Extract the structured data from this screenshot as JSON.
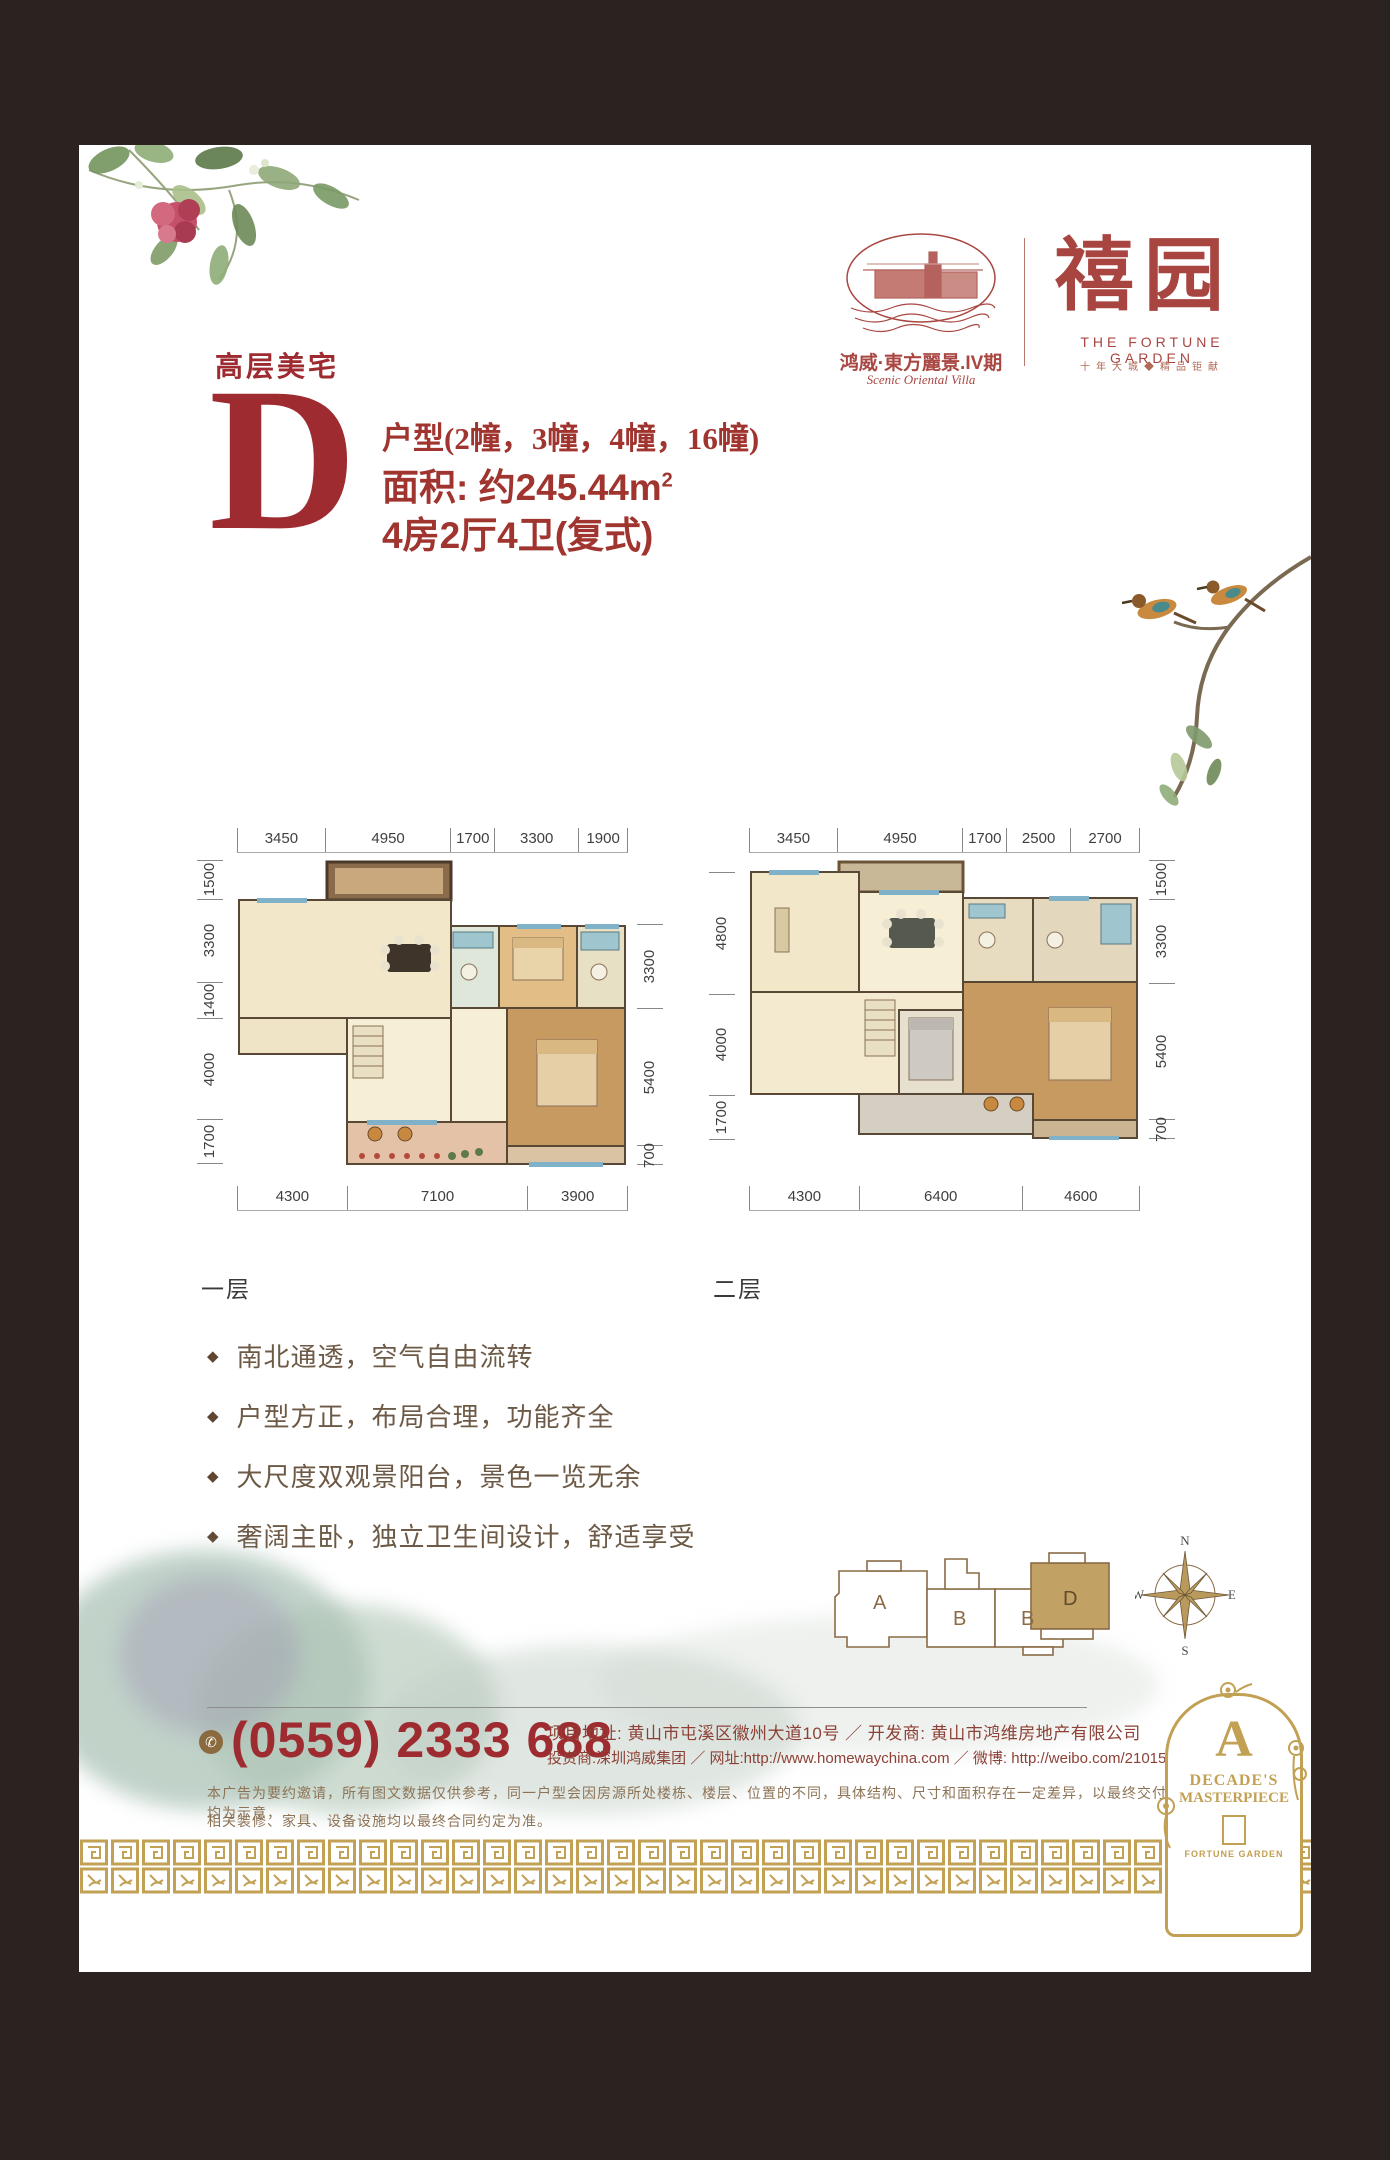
{
  "header": {
    "tagline": "高层美宅",
    "unit_letter": "D",
    "unit_type_line": "户型(2幢，3幢，4幢，16幢)",
    "area_label": "面积: 约245.44m",
    "area_sup": "2",
    "rooms_line": "4房2厅4卫(复式)"
  },
  "brand": {
    "left_logo_cn": "鸿威·東方麗景.IV期",
    "left_logo_en": "Scenic Oriental Villa",
    "right_logo_cn": "禧园",
    "right_logo_en": "THE FORTUNE GARDEN",
    "right_logo_sub": "十年大城◆精品钜献"
  },
  "plans": {
    "floor1": {
      "label": "一层",
      "top": [
        "3450",
        "4950",
        "1700",
        "3300",
        "1900"
      ],
      "left": [
        "1500",
        "3300",
        "1400",
        "4000",
        "1700"
      ],
      "right": [
        "3300",
        "5400",
        "700"
      ],
      "bottom": [
        "4300",
        "7100",
        "3900"
      ]
    },
    "floor2": {
      "label": "二层",
      "top": [
        "3450",
        "4950",
        "1700",
        "2500",
        "2700"
      ],
      "left": [
        "4800",
        "4000",
        "1700"
      ],
      "right": [
        "1500",
        "3300",
        "5400",
        "700"
      ],
      "bottom": [
        "4300",
        "6400",
        "4600"
      ]
    }
  },
  "features": [
    "南北通透，空气自由流转",
    "户型方正，布局合理，功能齐全",
    "大尺度双观景阳台，景色一览无余",
    "奢阔主卧，独立卫生间设计，舒适享受"
  ],
  "site_plan": {
    "units": [
      "A",
      "B",
      "B",
      "D"
    ],
    "highlighted": "D"
  },
  "compass": {
    "n": "N",
    "e": "E",
    "s": "S",
    "w": "W"
  },
  "contact": {
    "phone": "(0559) 2333 688",
    "line1": "项目地址: 黄山市屯溪区徽州大道10号 ／ 开发商: 黄山市鸿维房地产有限公司",
    "line2": "投资商:深圳鸿威集团 ／ 网址:http://www.homewaychina.com ／ 微博: http://weibo.com/2101586350"
  },
  "disclaimer": {
    "line1": "本广告为要约邀请，所有图文数据仅供参考，同一户型会因房源所处楼栋、楼层、位置的不同，具体结构、尺寸和面积存在一定差异，以最终交付实测为准；室内布局均为示意，",
    "line2": "相关装修、家具、设备设施均以最终合同约定为准。"
  },
  "ornament": {
    "monogram": "A",
    "line1": "DECADE'S",
    "line2": "MASTERPIECE",
    "line3": "FORTUNE GARDEN"
  },
  "colors": {
    "red": "#9e2b30",
    "gold": "#c2a054",
    "frame": "#2b2320",
    "brown_text": "#6d5a46"
  }
}
